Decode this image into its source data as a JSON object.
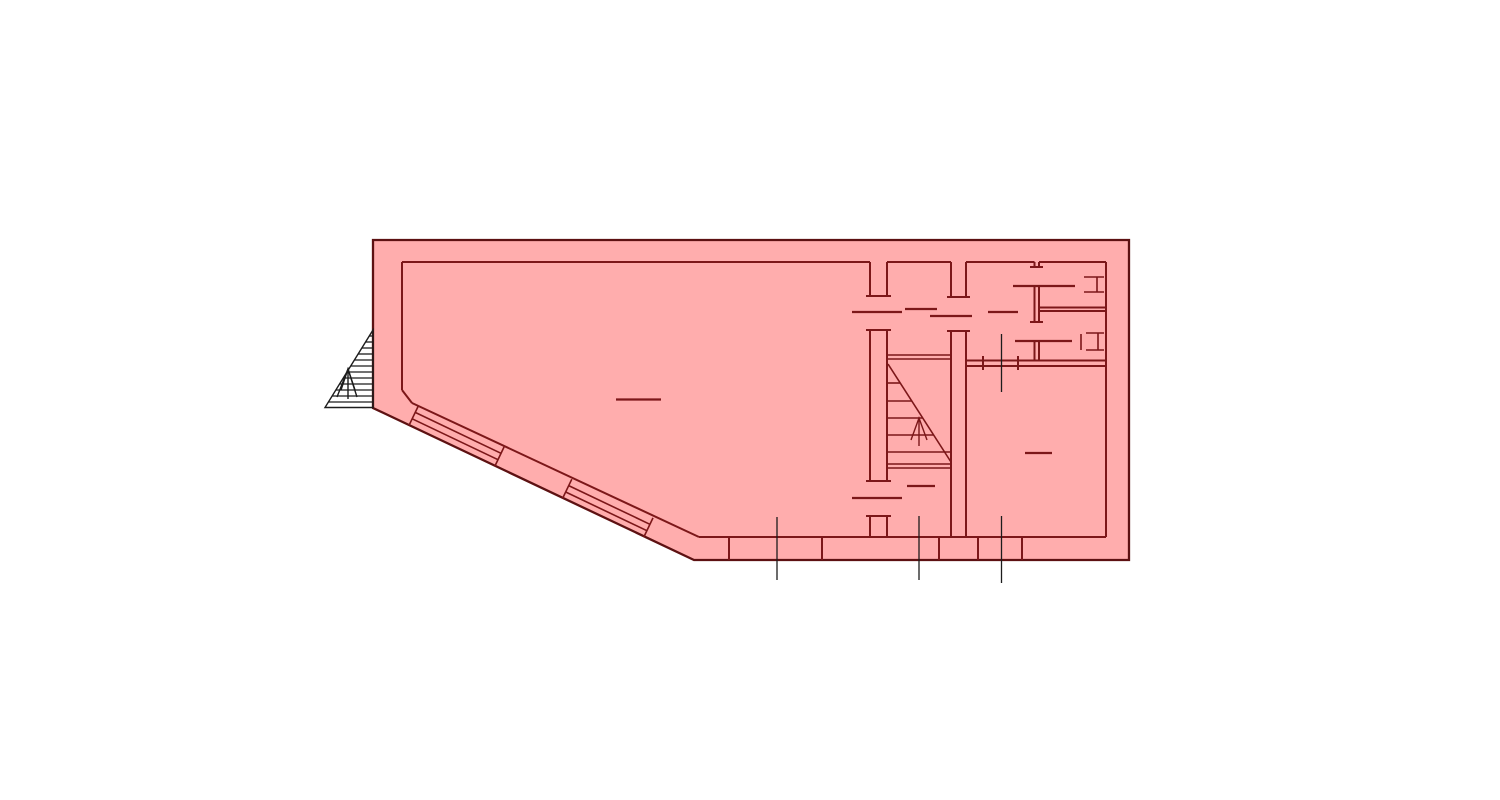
{
  "drawing": {
    "kind": "architectural-floor-plan",
    "canvas": {
      "width": 1500,
      "height": 800
    }
  },
  "colors": {
    "background": "#ffffff",
    "floor_fill": "#ffadad",
    "outline_stroke": "#5d1112",
    "wall_line": "#7c1719",
    "detail_line": "#1c1c1c"
  },
  "plan": {
    "outline_points": "373,240 1129,240 1129,560 694,560 373,408",
    "exterior_stair_points": "373,330 373,407.5 325,407.5",
    "line_groups": [
      {
        "name": "inner-walls",
        "style": "wall",
        "lines": [
          [
            402,
            262,
            870,
            262
          ],
          [
            887,
            262,
            951,
            262
          ],
          [
            966,
            262,
            1034.5,
            262
          ],
          [
            1039,
            262,
            1106,
            262
          ],
          [
            1106,
            262,
            1106,
            537
          ],
          [
            699,
            537,
            1106,
            537
          ],
          [
            402,
            262,
            402,
            390
          ],
          [
            402,
            390,
            412,
            403
          ],
          [
            412,
            403,
            699,
            537
          ],
          [
            870,
            262,
            870,
            296
          ],
          [
            870,
            330,
            870,
            481
          ],
          [
            870,
            516,
            870,
            537
          ],
          [
            887,
            262,
            887,
            296
          ],
          [
            887,
            330,
            887,
            481
          ],
          [
            887,
            516,
            887,
            537
          ],
          [
            951,
            262,
            951,
            297
          ],
          [
            951,
            331,
            951,
            537
          ],
          [
            966,
            262,
            966,
            297
          ],
          [
            966,
            331,
            966,
            537
          ],
          [
            1034.5,
            262,
            1034.5,
            267
          ],
          [
            1034.5,
            286,
            1034.5,
            322
          ],
          [
            1034.5,
            341,
            1034.5,
            360.5
          ],
          [
            1039,
            262,
            1039,
            267
          ],
          [
            1039,
            286,
            1039,
            322
          ],
          [
            1039,
            341,
            1039,
            360.5
          ],
          [
            1039,
            307.5,
            1106,
            307.5
          ],
          [
            1039,
            311,
            1106,
            311
          ],
          [
            966,
            360.5,
            1106,
            360.5
          ],
          [
            966,
            366,
            1106,
            366
          ]
        ]
      },
      {
        "name": "door-jamb-ticks",
        "style": "wall",
        "lines": [
          [
            866,
            296,
            891,
            296
          ],
          [
            866,
            330,
            891,
            330
          ],
          [
            866,
            481,
            891,
            481
          ],
          [
            866,
            516,
            891,
            516
          ],
          [
            947,
            297,
            970,
            297
          ],
          [
            947,
            331,
            970,
            331
          ],
          [
            1030,
            267,
            1043,
            267
          ],
          [
            1030,
            322,
            1043,
            322
          ],
          [
            983,
            356,
            983,
            370
          ],
          [
            1018,
            356,
            1018,
            370
          ],
          [
            729,
            537,
            729,
            560
          ],
          [
            822,
            537,
            822,
            560
          ],
          [
            939,
            537,
            939,
            560
          ],
          [
            978,
            537,
            978,
            560
          ],
          [
            1022,
            537,
            1022,
            560
          ]
        ]
      },
      {
        "name": "door-leaf-lines",
        "style": "dash",
        "lines": [
          [
            852,
            312,
            902,
            312
          ],
          [
            852,
            498,
            902,
            498
          ],
          [
            930,
            316,
            972,
            316
          ],
          [
            1013,
            286,
            1075,
            286
          ],
          [
            1015,
            341,
            1072,
            341
          ]
        ]
      },
      {
        "name": "room-label-dashes",
        "style": "dash",
        "lines": [
          [
            616,
            399.5,
            661,
            399.5
          ],
          [
            905,
            309,
            937,
            309
          ],
          [
            988,
            312,
            1018,
            312
          ],
          [
            907,
            486,
            935,
            486
          ],
          [
            1025,
            453,
            1052,
            453
          ]
        ]
      },
      {
        "name": "window-glazing",
        "style": "thin",
        "lines": [
          [
            412.2,
            418.8,
            498,
            459.7
          ],
          [
            415.2,
            412.4,
            501,
            453.3
          ],
          [
            409.1,
            425.2,
            418.3,
            406
          ],
          [
            494.9,
            466.1,
            504.1,
            446.9
          ],
          [
            565.7,
            492,
            646.9,
            530.7
          ],
          [
            568.7,
            485.6,
            649.9,
            524.3
          ],
          [
            562.6,
            498.4,
            571.8,
            479.2
          ],
          [
            643.8,
            537.1,
            653,
            517.9
          ]
        ]
      },
      {
        "name": "stair-lines",
        "style": "thin",
        "lines": [
          [
            887,
            355,
            951,
            355
          ],
          [
            887,
            359,
            951,
            359
          ],
          [
            887,
            464,
            951,
            464
          ],
          [
            887,
            468,
            951,
            468
          ],
          [
            888,
            364,
            951,
            462
          ],
          [
            887,
            383,
            900,
            383
          ],
          [
            887,
            401,
            912,
            401
          ],
          [
            887,
            418,
            923,
            418
          ],
          [
            887,
            435,
            934,
            435
          ],
          [
            887,
            452,
            951,
            452
          ]
        ]
      },
      {
        "name": "wc-fixtures",
        "style": "thin",
        "lines": [
          [
            1084,
            277,
            1104,
            277
          ],
          [
            1084,
            292,
            1104,
            292
          ],
          [
            1097,
            277,
            1097,
            292
          ],
          [
            1086,
            333,
            1104,
            333
          ],
          [
            1086,
            350,
            1104,
            350
          ],
          [
            1098,
            333,
            1098,
            350
          ],
          [
            1081,
            334,
            1081,
            350
          ]
        ]
      },
      {
        "name": "section-lines",
        "style": "detail",
        "lines": [
          [
            777,
            517,
            777,
            580
          ],
          [
            919,
            516,
            919,
            580
          ],
          [
            1001.5,
            516,
            1001.5,
            583
          ],
          [
            1001.5,
            334,
            1001.5,
            392
          ]
        ]
      },
      {
        "name": "exterior-stair-treads",
        "style": "detail",
        "lines": [
          [
            369.3,
            336,
            373,
            336
          ],
          [
            365.5,
            342,
            373,
            342
          ],
          [
            361.8,
            348,
            373,
            348
          ],
          [
            358,
            354,
            373,
            354
          ],
          [
            354.3,
            360,
            373,
            360
          ],
          [
            350.6,
            366,
            373,
            366
          ],
          [
            346.8,
            372,
            373,
            372
          ],
          [
            343.1,
            378,
            373,
            378
          ],
          [
            339.3,
            384,
            373,
            384
          ],
          [
            335.6,
            390,
            373,
            390
          ],
          [
            331.9,
            396,
            373,
            396
          ],
          [
            328.1,
            402,
            373,
            402
          ]
        ]
      }
    ],
    "arrows": [
      {
        "name": "stair-direction-arrow",
        "style": "dash",
        "shaft": [
          919,
          446,
          919,
          420
        ],
        "heads": [
          "911,440 919,418 927,440"
        ]
      },
      {
        "name": "exterior-stair-arrow",
        "style": "detail",
        "shaft": [
          348,
          399,
          348,
          371
        ],
        "heads": [
          "341,390 348,369 355,390",
          "337,397 348,369 357,397"
        ]
      }
    ]
  }
}
